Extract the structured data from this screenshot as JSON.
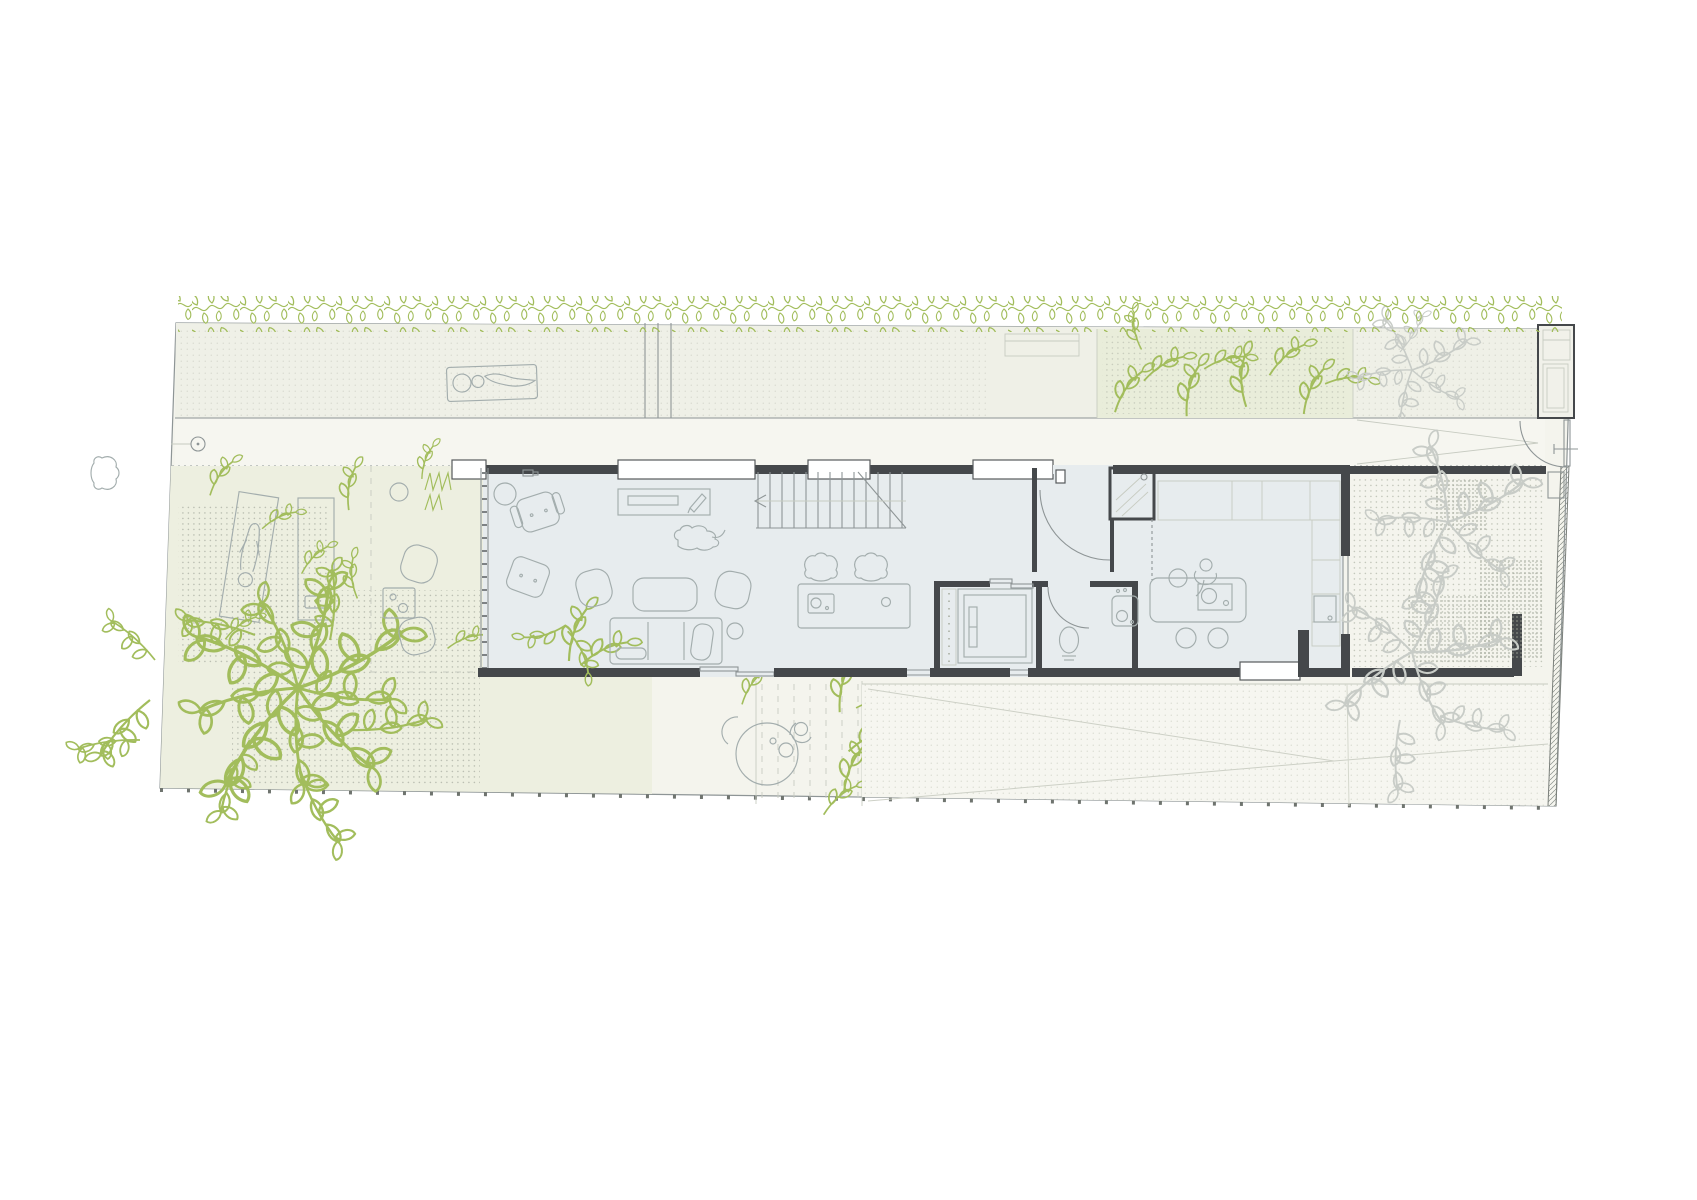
{
  "drawing": {
    "kind": "architectural-floor-plan",
    "areas": [
      "green-hedge",
      "roof-terrace-strip",
      "sun-lounger-deck",
      "planted-bed",
      "street-tree-strip",
      "entry-walkway",
      "west-garden",
      "gravel-patches",
      "sunbathing-area",
      "outdoor-lounge",
      "garden-tree",
      "south-patio",
      "pergola-decking",
      "driveway",
      "east-courtyard",
      "entry-gate",
      "pedestrian-gate",
      "boundary-fence"
    ],
    "rooms": [
      "living-room",
      "staircase",
      "entry-hall",
      "coat-closet",
      "utility-room",
      "bathroom",
      "kitchen"
    ],
    "furniture": [
      "side-table",
      "armchairs",
      "desk",
      "sofa",
      "coffee-table",
      "poufs",
      "indoor-plant",
      "dining-table",
      "dining-chairs",
      "kitchen-counter",
      "tall-cabinets",
      "kitchen-island",
      "bar-stools",
      "washing-machine",
      "toilet",
      "bathroom-sink",
      "outdoor-table",
      "sun-towels",
      "sun-lounger",
      "lounge-chairs",
      "lounge-table"
    ],
    "figures": [
      "person-on-lounger",
      "person-sunbathing",
      "person-at-patio-table",
      "person-cooking",
      "dog"
    ]
  },
  "colors": {
    "paper": "#ffffff",
    "site_fill": "#f4f4ed",
    "terrace_fill": "#eff0e7",
    "lawn_fill": "#edefe0",
    "bed_fill": "#e9edda",
    "floor_fill": "#e7ecee",
    "wall": "#45484b",
    "line": "#8e9596",
    "furniture_line": "#a3adad",
    "light_line": "#c7cbc1",
    "plant_green": "#a2bd5c",
    "tree_gray": "#c8ccc7",
    "dot": "#b2b7a9",
    "hatch": "#8a8f8a"
  }
}
